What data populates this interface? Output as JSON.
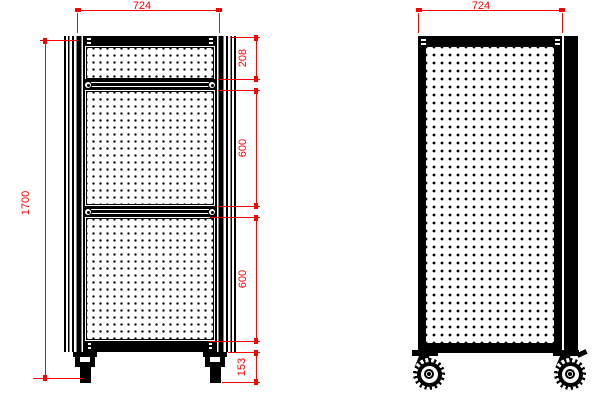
{
  "drawing": {
    "type": "technical-drawing",
    "subject": "perforated panel trolley, front and side views",
    "colors": {
      "dimension_red": "#ff0000",
      "ink": "#000000",
      "paper": "#ffffff"
    },
    "views": {
      "front": {
        "width_dim": "724",
        "height_dim": "1700",
        "right_chain": [
          "208",
          "600",
          "600",
          "153"
        ]
      },
      "side": {
        "width_dim": "724"
      }
    }
  }
}
